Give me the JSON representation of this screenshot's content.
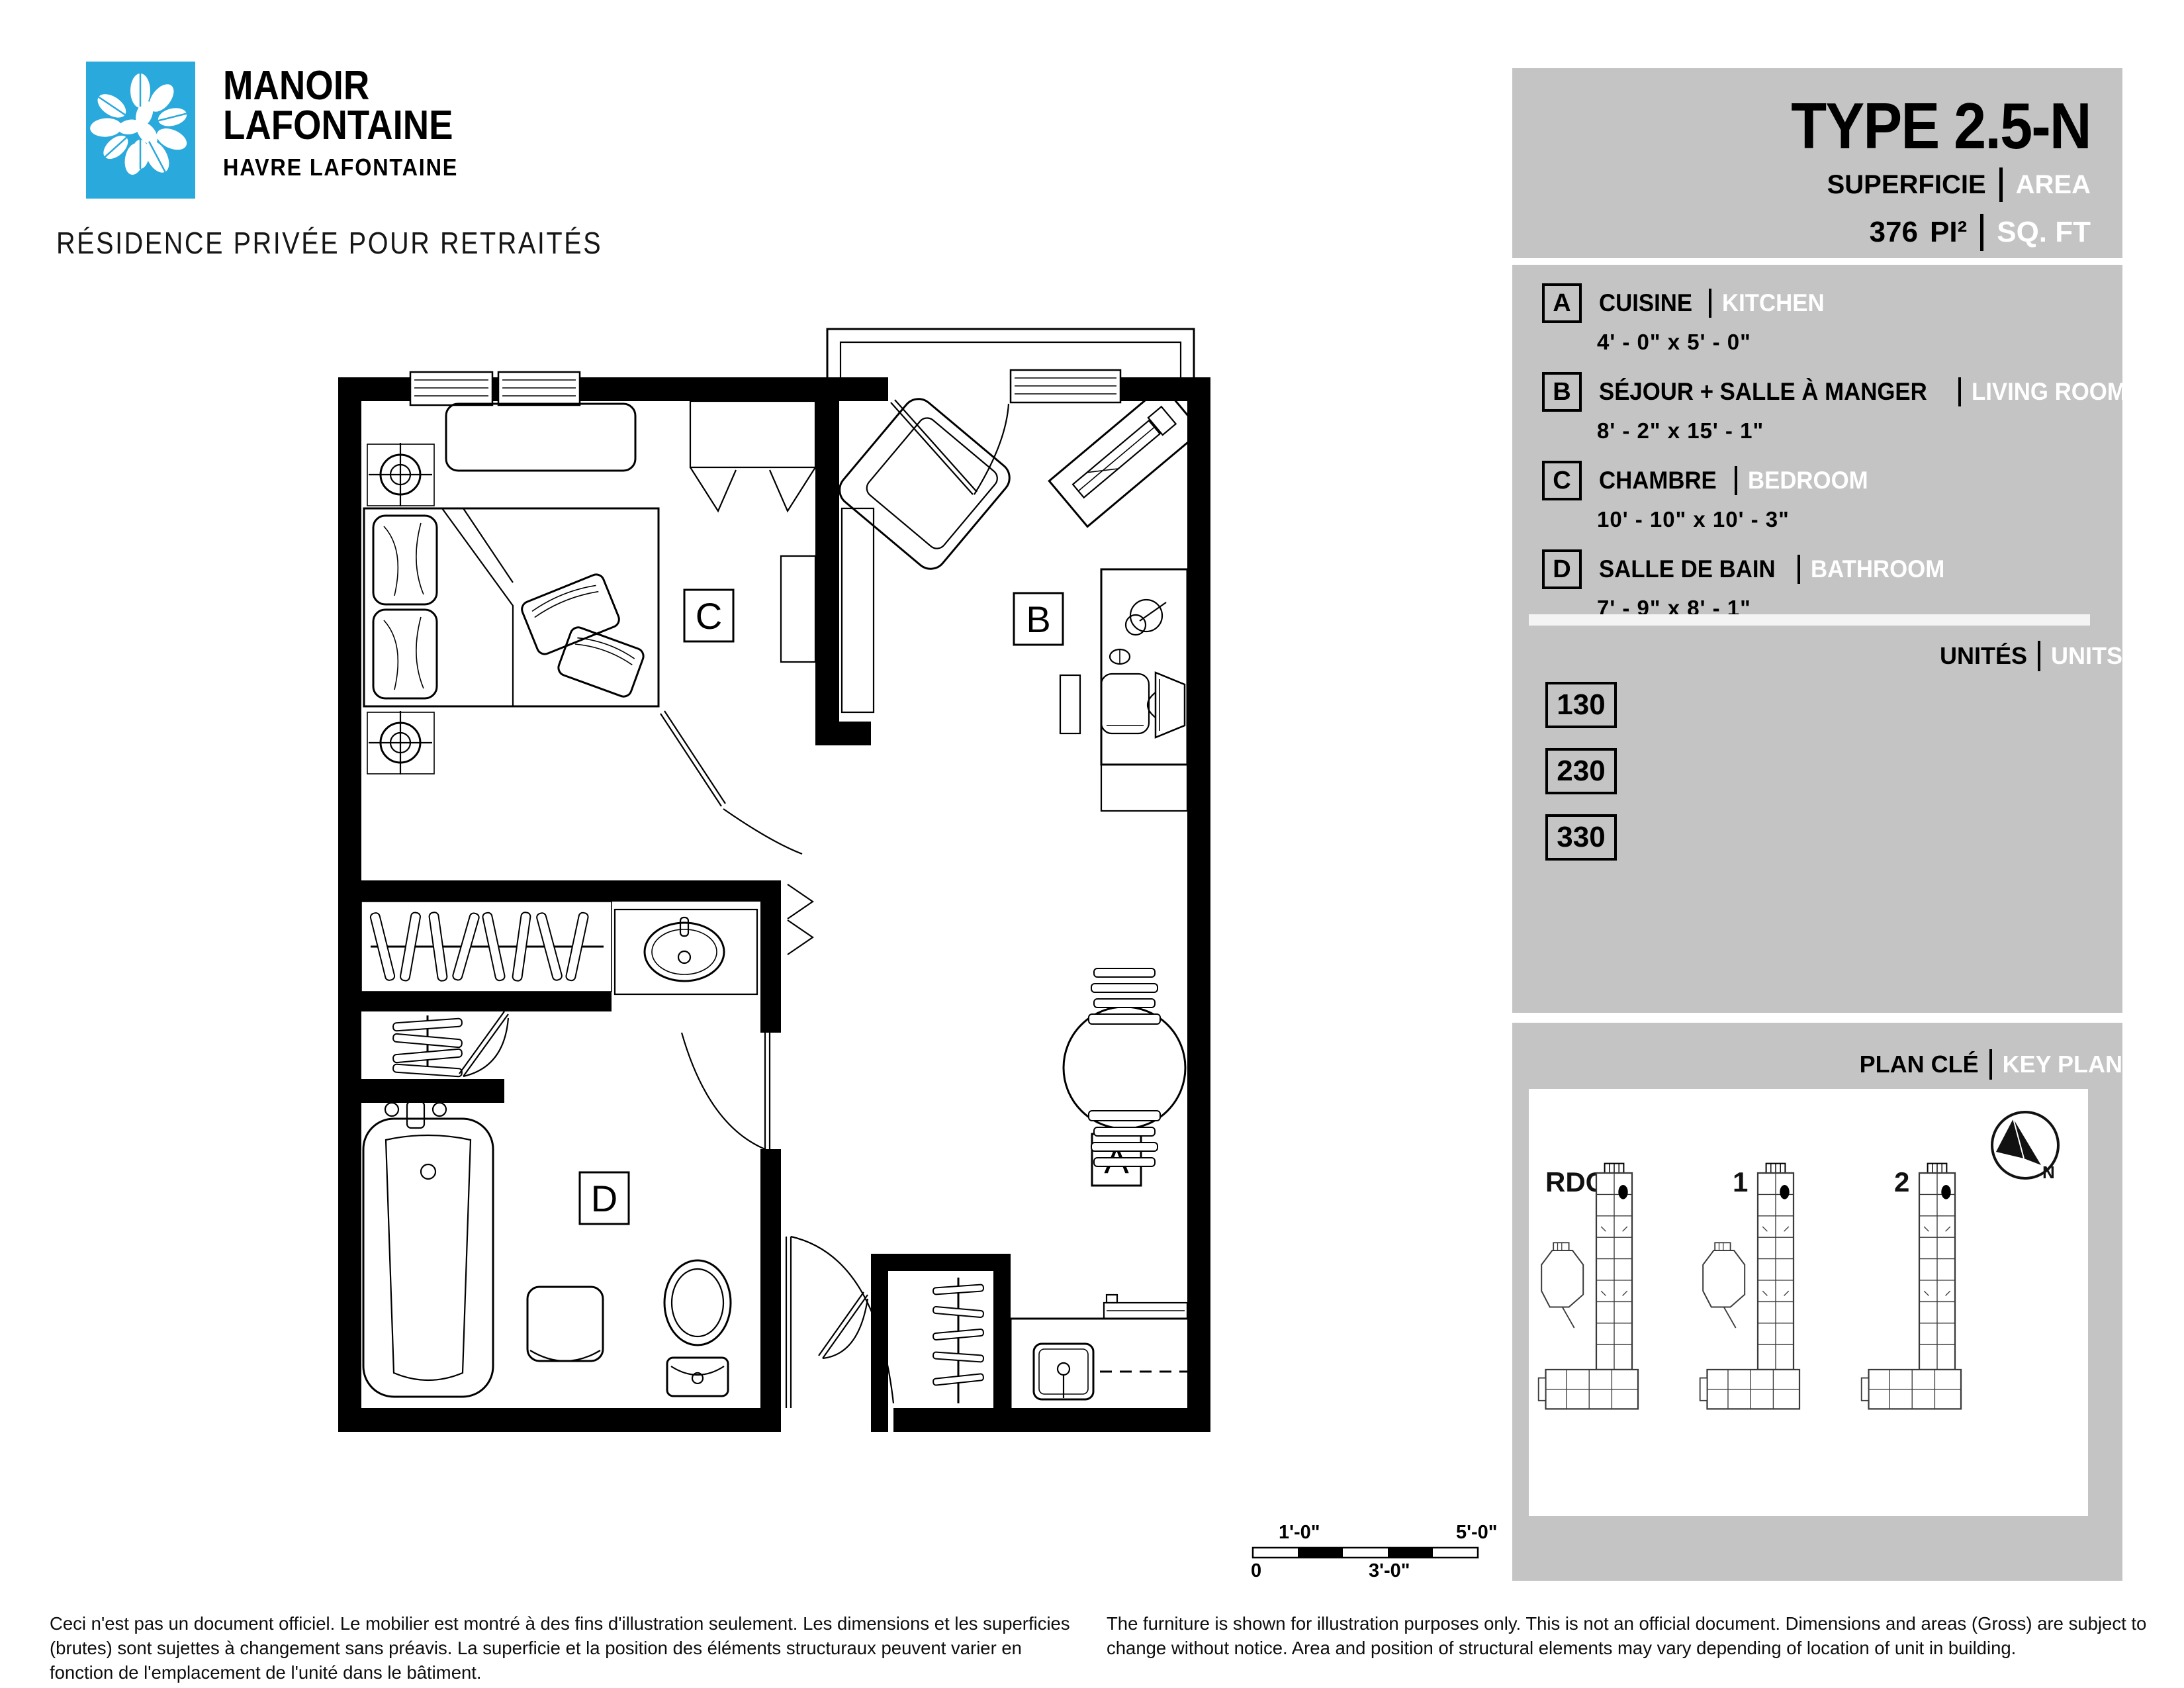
{
  "brand": {
    "name_line1": "MANOIR",
    "name_line2": "LAFONTAINE",
    "subtitle": "HAVRE LAFONTAINE",
    "tagline": "RÉSIDENCE PRIVÉE POUR RETRAITÉS"
  },
  "header": {
    "unit_type": "TYPE 2.5-N",
    "superficie_label": "SUPERFICIE",
    "area_label": "AREA",
    "area_value": "376",
    "area_unit_fr": "PI²",
    "area_unit_en": "SQ. FT"
  },
  "legend": {
    "items": [
      {
        "letter": "A",
        "name_fr": "CUISINE",
        "name_en": "KITCHEN",
        "dimensions": "4' - 0\" x 5' - 0\""
      },
      {
        "letter": "B",
        "name_fr": "SÉJOUR + SALLE À MANGER",
        "name_en": "LIVING ROOM + DINING",
        "dimensions": "8' - 2\" x 15' - 1\""
      },
      {
        "letter": "C",
        "name_fr": "CHAMBRE",
        "name_en": "BEDROOM",
        "dimensions": "10' -  10\" x 10' - 3\""
      },
      {
        "letter": "D",
        "name_fr": "SALLE DE BAIN",
        "name_en": "BATHROOM",
        "dimensions": "7' -  9\" x 8' - 1\""
      }
    ]
  },
  "units": {
    "title_fr": "UNITÉS",
    "title_en": "UNITS",
    "numbers": [
      "130",
      "230",
      "330"
    ]
  },
  "key_plan": {
    "title_fr": "PLAN CLÉ",
    "title_en": "KEY PLAN",
    "floors": [
      "RDC",
      "1",
      "2"
    ],
    "north_label": "N"
  },
  "floor_plan": {
    "labels": {
      "kitchen": "A",
      "living": "B",
      "bedroom": "C",
      "bathroom": "D"
    }
  },
  "scale_bar": {
    "zero": "0",
    "one_ft": "1'-0\"",
    "three_ft": "3'-0\"",
    "five_ft": "5'-0\""
  },
  "footer": {
    "fr": "Ceci n'est pas un document officiel. Le mobilier est montré à des fins d'illustration seulement. Les dimensions et les superficies (brutes) sont sujettes à changement sans préavis. La superficie et la position des éléments structuraux peuvent varier en fonction de l'emplacement de l'unité dans le bâtiment.",
    "en": "The furniture is shown for illustration purposes only. This is not an official document. Dimensions and areas (Gross) are subject to change without notice. Area and position of structural elements may vary depending of location of unit in building."
  },
  "colors": {
    "brand_blue": "#29a9dc",
    "panel_gray": "#c4c4c4",
    "divider_white": "#f4f4f4",
    "ink": "#000000"
  }
}
